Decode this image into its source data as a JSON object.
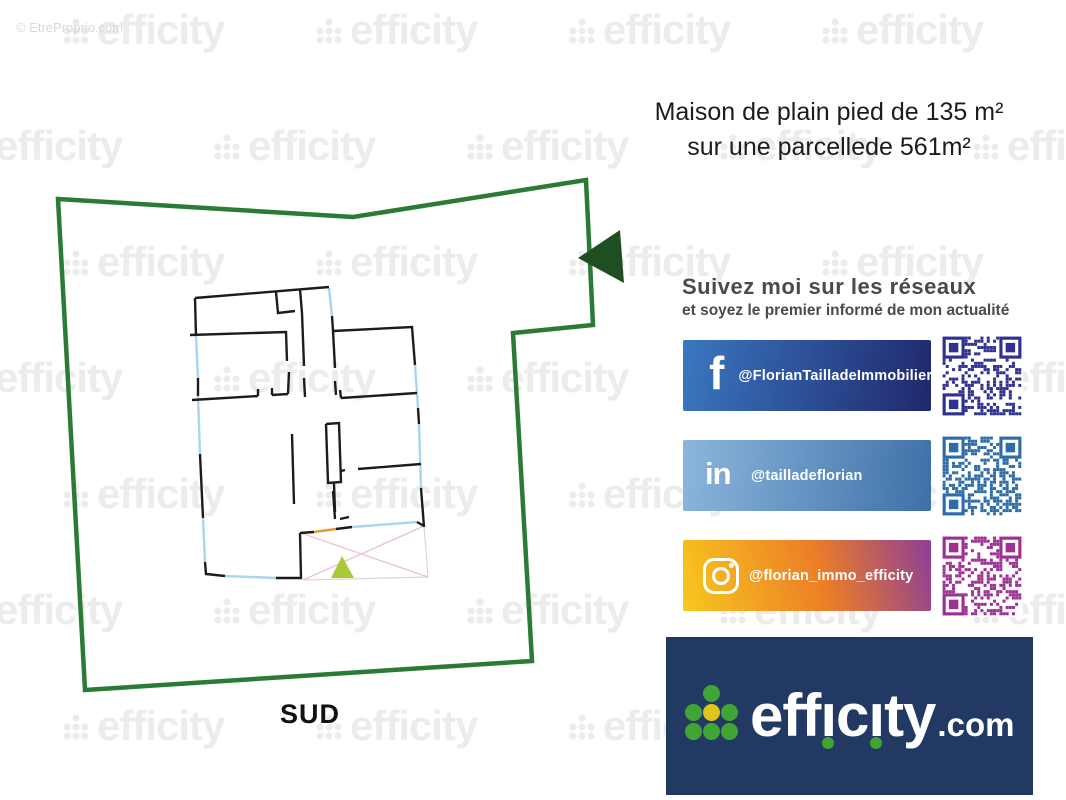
{
  "copyright": "© EtreProprio.com",
  "watermark": {
    "text": "efficity"
  },
  "title": {
    "line1": "Maison de plain pied de 135 m²",
    "line2": "sur une parcellede 561m²"
  },
  "plan": {
    "orientation_label": "SUD"
  },
  "social": {
    "heading": "Suivez moi sur les réseaux",
    "subheading": "et soyez le premier informé de mon actualité",
    "items": [
      {
        "network": "facebook",
        "handle": "@FlorianTailladeImmobilier",
        "qr_color": "#2e3191",
        "gradient": [
          "#3a77c0",
          "#20286d"
        ]
      },
      {
        "network": "linkedin",
        "handle": "@tailladeflorian",
        "qr_color": "#2d6ca8",
        "gradient": [
          "#8cb6dc",
          "#3e70a7"
        ]
      },
      {
        "network": "instagram",
        "handle": "@florian_immo_efficity",
        "qr_color": "#9d3092",
        "gradient": [
          "#f7c81f",
          "#ec7e26",
          "#8d3e97"
        ]
      }
    ]
  },
  "brand": {
    "name": "efficity",
    "tld": ".com"
  },
  "colors": {
    "parcel_green": "#2b7a36",
    "arrow_green": "#1f4e22",
    "wall_black": "#1c1c1c",
    "window_blue": "#a9d6ef",
    "terrace_pink": "#eec3cb",
    "door_orange": "#e09b3d",
    "triangle_green": "#a9c93a",
    "watermark_gray": "#ececec",
    "text_dark": "#1c1c1c",
    "social_text": "#4a4a4a",
    "brand_bg": "#223a63",
    "dot_green": "#41a536",
    "dot_yellow": "#e0c41e"
  }
}
